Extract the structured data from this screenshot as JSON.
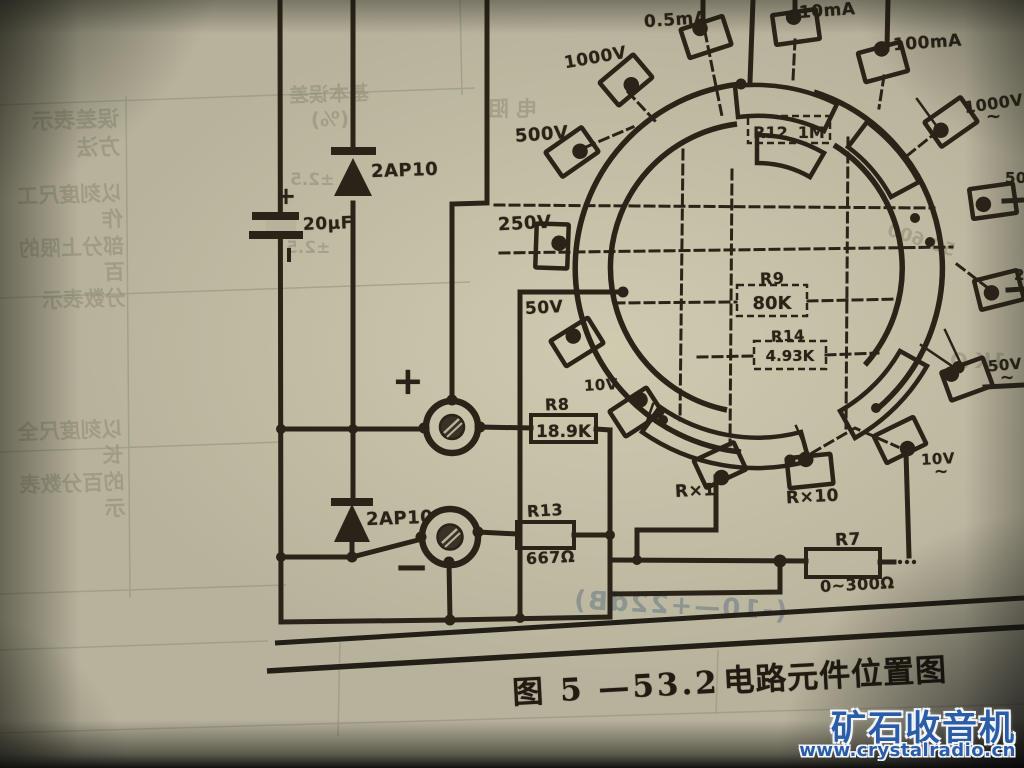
{
  "labels": {
    "i0_5mA": "0.5mA",
    "i10mA": "10mA",
    "i100mA": "100mA",
    "v1000_top": "1000V",
    "v500_left": "500V",
    "v250_left": "250V",
    "v50_left": "50V",
    "v10_left": "10V",
    "v1000_right": "1000V",
    "v500_right": "500V",
    "v250_right": "250V",
    "v50_right": "50V",
    "v10_right": "10V",
    "ac_tilde": "~",
    "rx1": "R×1",
    "rx10": "R×10",
    "plus": "+",
    "minus": "−"
  },
  "components": {
    "r7": {
      "ref": "R7",
      "value": "0~300Ω"
    },
    "r8": {
      "ref": "R8",
      "value": "18.9K"
    },
    "r9": {
      "ref": "R9",
      "value": "80K"
    },
    "r12": {
      "ref": "R12",
      "value": "1M"
    },
    "r13": {
      "ref": "R13",
      "value": "667Ω"
    },
    "r14": {
      "ref": "R14",
      "value": "4.93K"
    },
    "diode_top": "2AP10",
    "diode_bottom": "2AP10",
    "capacitor": "20μF"
  },
  "caption": {
    "number": "图 5 —53.2",
    "title": "电路元件位置图"
  },
  "watermark": {
    "name": "矿石收音机",
    "url": "www.crystalradio.cn",
    "color": "#2b5ca8"
  },
  "bleedthrough": {
    "col_header": "基本误差\n(%)",
    "err1": "±2.5",
    "err2": "±2.5",
    "method_header": "误差表示\n方法",
    "method1": "以刻度尺工作\n部分上限的百\n分数表示",
    "method2": "以刻度尺全长\n的百分数表示",
    "row_label": "电  阻",
    "range": "50-600",
    "k_value": "1K Ω",
    "note": "(-10—+22dB)"
  }
}
